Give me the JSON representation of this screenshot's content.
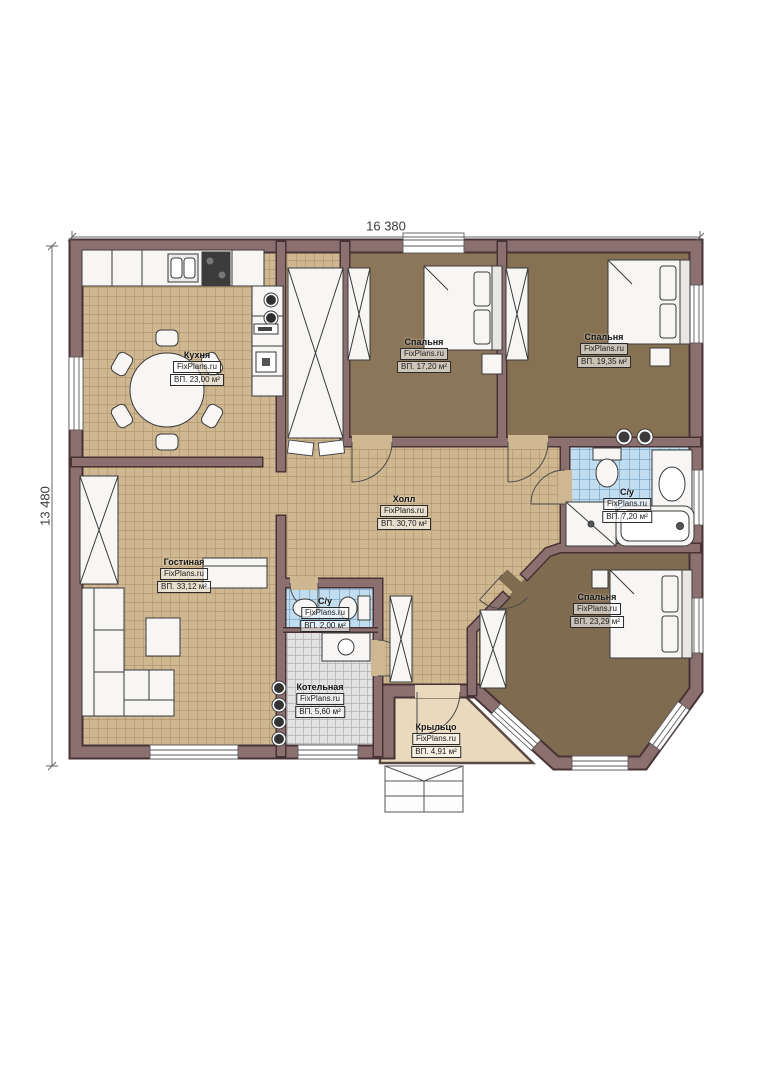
{
  "meta": {
    "watermark": "FixPlans.ru"
  },
  "dimensions": {
    "width": "16 380",
    "height": "13 480"
  },
  "rooms": {
    "kitchen": {
      "name": "Кухня",
      "area": "ВП. 23,00 м²"
    },
    "bedroom1": {
      "name": "Спальня",
      "area": "ВП. 17,20 м²"
    },
    "bedroom2": {
      "name": "Спальня",
      "area": "ВП. 19,35 м²"
    },
    "hall": {
      "name": "Холл",
      "area": "ВП. 30,70 м²"
    },
    "bathroom_main": {
      "name": "С/у",
      "area": "ВП. 7,20 м²"
    },
    "living": {
      "name": "Гостиная",
      "area": "ВП. 33,12 м²"
    },
    "bathroom_small": {
      "name": "С/у",
      "area": "ВП. 2,00 м²"
    },
    "boiler": {
      "name": "Котельная",
      "area": "ВП. 5,60 м²"
    },
    "bedroom3": {
      "name": "Спальня",
      "area": "ВП. 23,29 м²"
    },
    "porch": {
      "name": "Крыльцо",
      "area": "ВП. 4,91 м²"
    }
  },
  "colors": {
    "wall": "#8c7070",
    "wall_outline": "#473335",
    "floor_tile_beige": "#cfb891",
    "bedroom_carpet": "#8a7355",
    "bathroom_tile_blue": "#c2ddef",
    "boiler_tile_gray": "#e2e2e2",
    "porch_floor": "#ead9bd",
    "fixture_white": "#f7f6f4"
  }
}
